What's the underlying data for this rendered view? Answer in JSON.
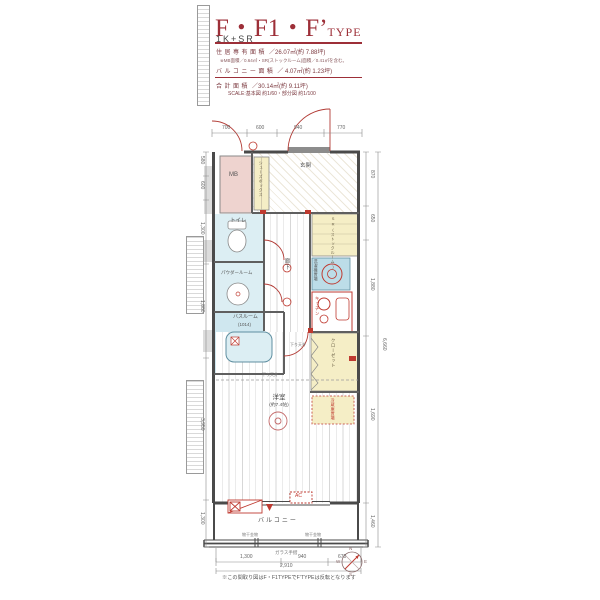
{
  "colors": {
    "accent": "#9d2f38",
    "wall": "#4a4a4a",
    "red": "#bf3a30",
    "pink": "#eed3cf",
    "yellow": "#f5eec6",
    "blue": "#cfe7ef"
  },
  "header": {
    "title": "F・F1・F’",
    "type_suffix": "TYPE",
    "subtitle": "1K+SR",
    "rows": [
      {
        "label": "住居専有面積",
        "value": "／26.07㎡(約 7.88坪)"
      },
      {
        "label": "バルコニー面積",
        "value": "／ 4.07㎡(約 1.23坪)"
      },
      {
        "label": "合計面積",
        "value": "／30.14㎡(約 9.11坪)"
      }
    ],
    "note": "※MB面積／0.64㎡・SR(ストックルーム)面積／0.41㎡を含む。",
    "scale": "SCALE:基本図 約1/60・部分図 約1/100"
  },
  "plan": {
    "labels": {
      "mb": "MB",
      "genkan": "玄関",
      "shoes": "シューズボックス",
      "toilet": "トイレ",
      "powder": "パウダールーム",
      "bath": "バスルーム",
      "bath_size": "(1014)",
      "hall": "廊下",
      "sr": "SR(ストックルーム)",
      "washer": "洗濯機置場",
      "kitchen": "キッチン",
      "fridge": "冷蔵庫置場",
      "closet": "クローゼット",
      "room": "洋室",
      "room_size": "(約7.4帖)",
      "balcony": "バルコニー",
      "ac": "AC",
      "glass_rail": "ガラス手摺",
      "laundry_bracket": "物干金物",
      "drop_ceiling": "下り天井"
    },
    "note": "※この間取り図はF・F1TYPEでF’TYPEは反転となります",
    "dims": {
      "top": [
        "700",
        "600",
        "940",
        "770"
      ],
      "bottom": [
        "1,300",
        "940",
        "670"
      ],
      "bottom_total": "2,910",
      "left": [
        "580",
        "600",
        "1,300",
        "1,880",
        "3,950",
        "1,300"
      ],
      "right": [
        "870",
        "650",
        "1,880",
        "1,690",
        "1,460"
      ],
      "right_total": "6,660"
    },
    "compass": {
      "n": "N",
      "e": "E",
      "s": "S",
      "w": "W"
    }
  }
}
